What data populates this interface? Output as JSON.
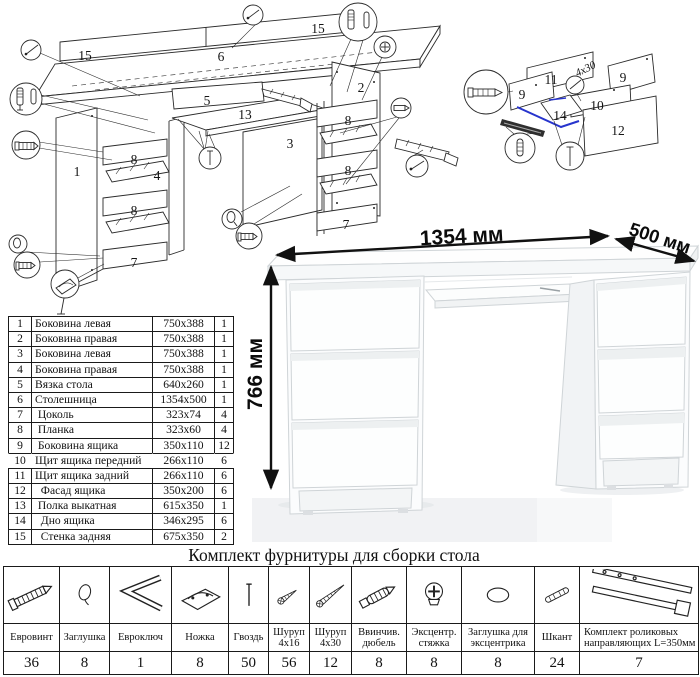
{
  "diagram": {
    "main_labels": [
      "15",
      "6",
      "15",
      "5",
      "13",
      "3",
      "2",
      "1",
      "8",
      "4",
      "8",
      "7",
      "8",
      "8",
      "7"
    ],
    "drawer_labels": [
      "11",
      "9",
      "9",
      "10",
      "12",
      "14"
    ],
    "screw_note": "4x30"
  },
  "parts_table": {
    "rows": [
      {
        "num": "1",
        "name": "Боковина левая",
        "size": "750x388",
        "qty": "1",
        "cls": ""
      },
      {
        "num": "2",
        "name": "Боковина правая",
        "size": "750x388",
        "qty": "1",
        "cls": ""
      },
      {
        "num": "3",
        "name": "Боковина левая",
        "size": "750x388",
        "qty": "1",
        "cls": ""
      },
      {
        "num": "4",
        "name": "Боковина правая",
        "size": "750x388",
        "qty": "1",
        "cls": ""
      },
      {
        "num": "5",
        "name": "Вязка стола",
        "size": "640x260",
        "qty": "1",
        "cls": ""
      },
      {
        "num": "6",
        "name": "Столешница",
        "size": "1354x500",
        "qty": "1",
        "cls": ""
      },
      {
        "num": "7",
        "name": " Цоколь",
        "size": "323x74",
        "qty": "4",
        "cls": ""
      },
      {
        "num": "8",
        "name": " Планка",
        "size": "323x60",
        "qty": "4",
        "cls": ""
      },
      {
        "num": "9",
        "name": " Боковина ящика",
        "size": "350x110",
        "qty": "12",
        "cls": ""
      },
      {
        "num": "10",
        "name": "Щит ящика передний",
        "size": "266x110",
        "qty": "6",
        "cls": "row-open"
      },
      {
        "num": "11",
        "name": "Щит ящика задний",
        "size": "266x110",
        "qty": "6",
        "cls": ""
      },
      {
        "num": "12",
        "name": "  Фасад ящика",
        "size": "350x200",
        "qty": "6",
        "cls": ""
      },
      {
        "num": "13",
        "name": " Полка выкатная",
        "size": "615x350",
        "qty": "1",
        "cls": ""
      },
      {
        "num": "14",
        "name": "  Дно ящика",
        "size": "346x295",
        "qty": "6",
        "cls": ""
      },
      {
        "num": "15",
        "name": "  Стенка задняя",
        "size": "675x350",
        "qty": "2",
        "cls": ""
      }
    ]
  },
  "desk": {
    "width_label": "1354 мм",
    "depth_label": "500 мм",
    "height_label": "766 мм"
  },
  "hardware": {
    "title": "Комплект фурнитуры для сборки стола",
    "items": [
      {
        "name": "Евровинт",
        "qty": "36"
      },
      {
        "name": "Заглушка",
        "qty": "8"
      },
      {
        "name": "Евроключ",
        "qty": "1"
      },
      {
        "name": "Ножка",
        "qty": "8"
      },
      {
        "name": "Гвоздь",
        "qty": "50"
      },
      {
        "name": "Шуруп 4x16",
        "qty": "56"
      },
      {
        "name": "Шуруп 4x30",
        "qty": "12"
      },
      {
        "name": "Ввинчив. дюбель",
        "qty": "8"
      },
      {
        "name": "Эксцентр. стяжка",
        "qty": "8"
      },
      {
        "name": "Заглушка для эксцентрика",
        "qty": "8"
      },
      {
        "name": "Шкант",
        "qty": "24"
      },
      {
        "name": "Комплект роликовых направляющих L=350мм",
        "qty": "7"
      }
    ]
  }
}
